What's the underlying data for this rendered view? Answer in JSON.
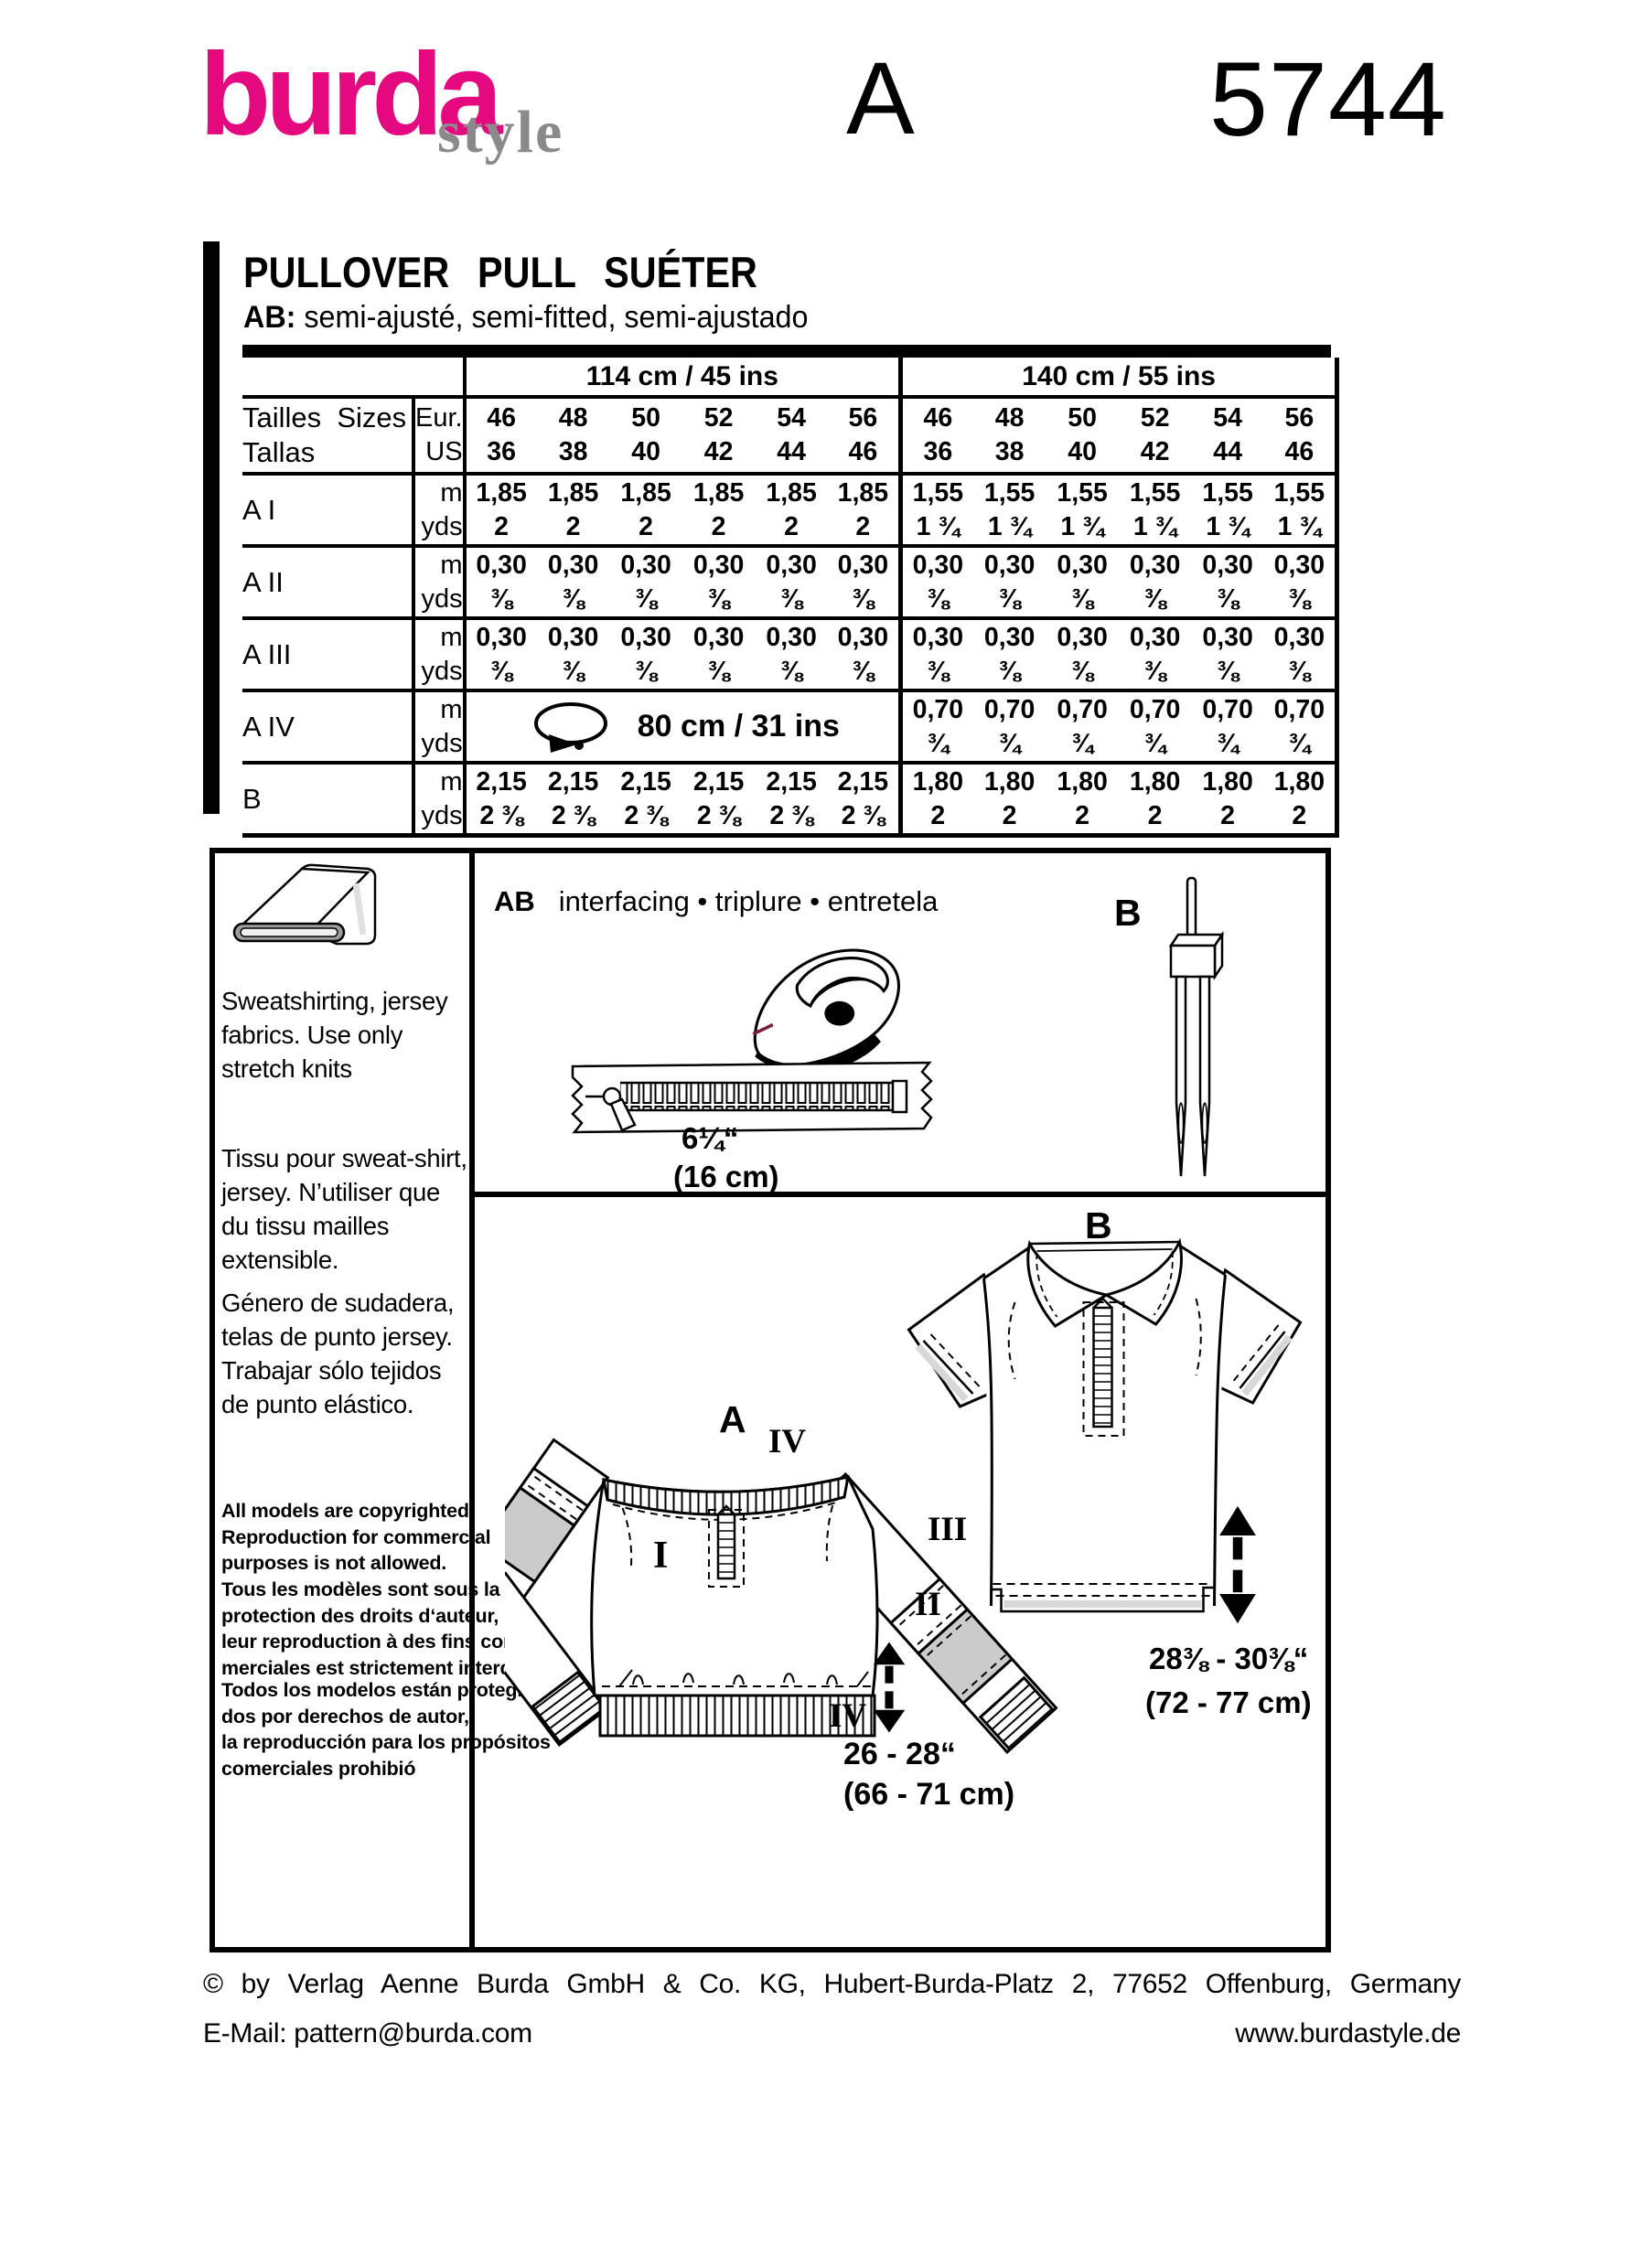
{
  "header": {
    "brand": "burda",
    "brand_sub": "style",
    "view_letter": "A",
    "pattern_number": "5744"
  },
  "title": {
    "main": "PULLOVER PULL SUÉTER",
    "fit_prefix": "AB:",
    "fit_text": " semi-ajusté, semi-fitted, semi-ajustado"
  },
  "table": {
    "group_headers": [
      "114 cm / 45 ins",
      "140 cm / 55 ins"
    ],
    "sizes_label": "Tailles  Sizes\nTallas",
    "eur": "Eur.",
    "us": "US",
    "m": "m",
    "yds": "yds",
    "sizes_eur": [
      "46",
      "48",
      "50",
      "52",
      "54",
      "56"
    ],
    "sizes_us": [
      "36",
      "38",
      "40",
      "42",
      "44",
      "46"
    ],
    "rows": [
      {
        "label": "A I",
        "g1m": [
          "1,85",
          "1,85",
          "1,85",
          "1,85",
          "1,85",
          "1,85"
        ],
        "g1y": [
          "2",
          "2",
          "2",
          "2",
          "2",
          "2"
        ],
        "g2m": [
          "1,55",
          "1,55",
          "1,55",
          "1,55",
          "1,55",
          "1,55"
        ],
        "g2y": [
          "1 ¾",
          "1 ¾",
          "1 ¾",
          "1 ¾",
          "1 ¾",
          "1 ¾"
        ]
      },
      {
        "label": "A II",
        "g1m": [
          "0,30",
          "0,30",
          "0,30",
          "0,30",
          "0,30",
          "0,30"
        ],
        "g1y": [
          "⅜",
          "⅜",
          "⅜",
          "⅜",
          "⅜",
          "⅜"
        ],
        "g2m": [
          "0,30",
          "0,30",
          "0,30",
          "0,30",
          "0,30",
          "0,30"
        ],
        "g2y": [
          "⅜",
          "⅜",
          "⅜",
          "⅜",
          "⅜",
          "⅜"
        ]
      },
      {
        "label": "A III",
        "g1m": [
          "0,30",
          "0,30",
          "0,30",
          "0,30",
          "0,30",
          "0,30"
        ],
        "g1y": [
          "⅜",
          "⅜",
          "⅜",
          "⅜",
          "⅜",
          "⅜"
        ],
        "g2m": [
          "0,30",
          "0,30",
          "0,30",
          "0,30",
          "0,30",
          "0,30"
        ],
        "g2y": [
          "⅜",
          "⅜",
          "⅜",
          "⅜",
          "⅜",
          "⅜"
        ]
      },
      {
        "label": "A IV",
        "elastic": "80 cm / 31 ins",
        "g2m": [
          "0,70",
          "0,70",
          "0,70",
          "0,70",
          "0,70",
          "0,70"
        ],
        "g2y": [
          "¾",
          "¾",
          "¾",
          "¾",
          "¾",
          "¾"
        ]
      },
      {
        "label": "B",
        "g1m": [
          "2,15",
          "2,15",
          "2,15",
          "2,15",
          "2,15",
          "2,15"
        ],
        "g1y": [
          "2 ⅜",
          "2 ⅜",
          "2 ⅜",
          "2 ⅜",
          "2 ⅜",
          "2 ⅜"
        ],
        "g2m": [
          "1,80",
          "1,80",
          "1,80",
          "1,80",
          "1,80",
          "1,80"
        ],
        "g2y": [
          "2",
          "2",
          "2",
          "2",
          "2",
          "2"
        ]
      }
    ]
  },
  "fabric_panel": {
    "en": "Sweatshirting, jersey\nfabrics. Use only\nstretch knits",
    "fr": "Tissu pour sweat-shirt,\njersey. N’utiliser que\ndu tissu mailles\nextensible.",
    "es": "Género de sudadera,\ntelas de punto jersey.\nTrabajar sólo tejidos\nde punto elástico.",
    "copyright_en": "All models are copyrighted.\nReproduction for commercial\npurposes is not allowed.",
    "copyright_fr": "Tous les modèles sont sous la\nprotection des droits d‘auteur,\nleur reproduction à des fins com-\nmerciales est strictement interdite.",
    "copyright_es": "Todos los modelos están protegi-\ndos por derechos de autor,\nla reproducción para los propósitos\ncomerciales prohibió"
  },
  "notions_panel": {
    "ab": "AB",
    "interfacing": "interfacing • triplure • entretela",
    "b": "B",
    "zip_in": "6¼“",
    "zip_cm": "(16 cm)"
  },
  "views": {
    "a": "A",
    "b": "B",
    "i": "I",
    "ii": "II",
    "iii": "III",
    "iv_neck": "IV",
    "iv_hem": "IV",
    "a_in": "26 - 28“",
    "a_cm": "(66 - 71 cm)",
    "b_in": "28⅜ - 30⅜“",
    "b_cm": "(72 - 77 cm)"
  },
  "footer": {
    "line1": "© by Verlag Aenne Burda GmbH & Co. KG, Hubert-Burda-Platz 2, 77652 Offenburg, Germany",
    "email": "E-Mail: pattern@burda.com",
    "site": "www.burdastyle.de"
  },
  "colors": {
    "magenta": "#e5097f",
    "logo_gray": "#8a8a8c",
    "band_gray": "#cbcbcb",
    "shade_gray": "#d8d8d8"
  }
}
